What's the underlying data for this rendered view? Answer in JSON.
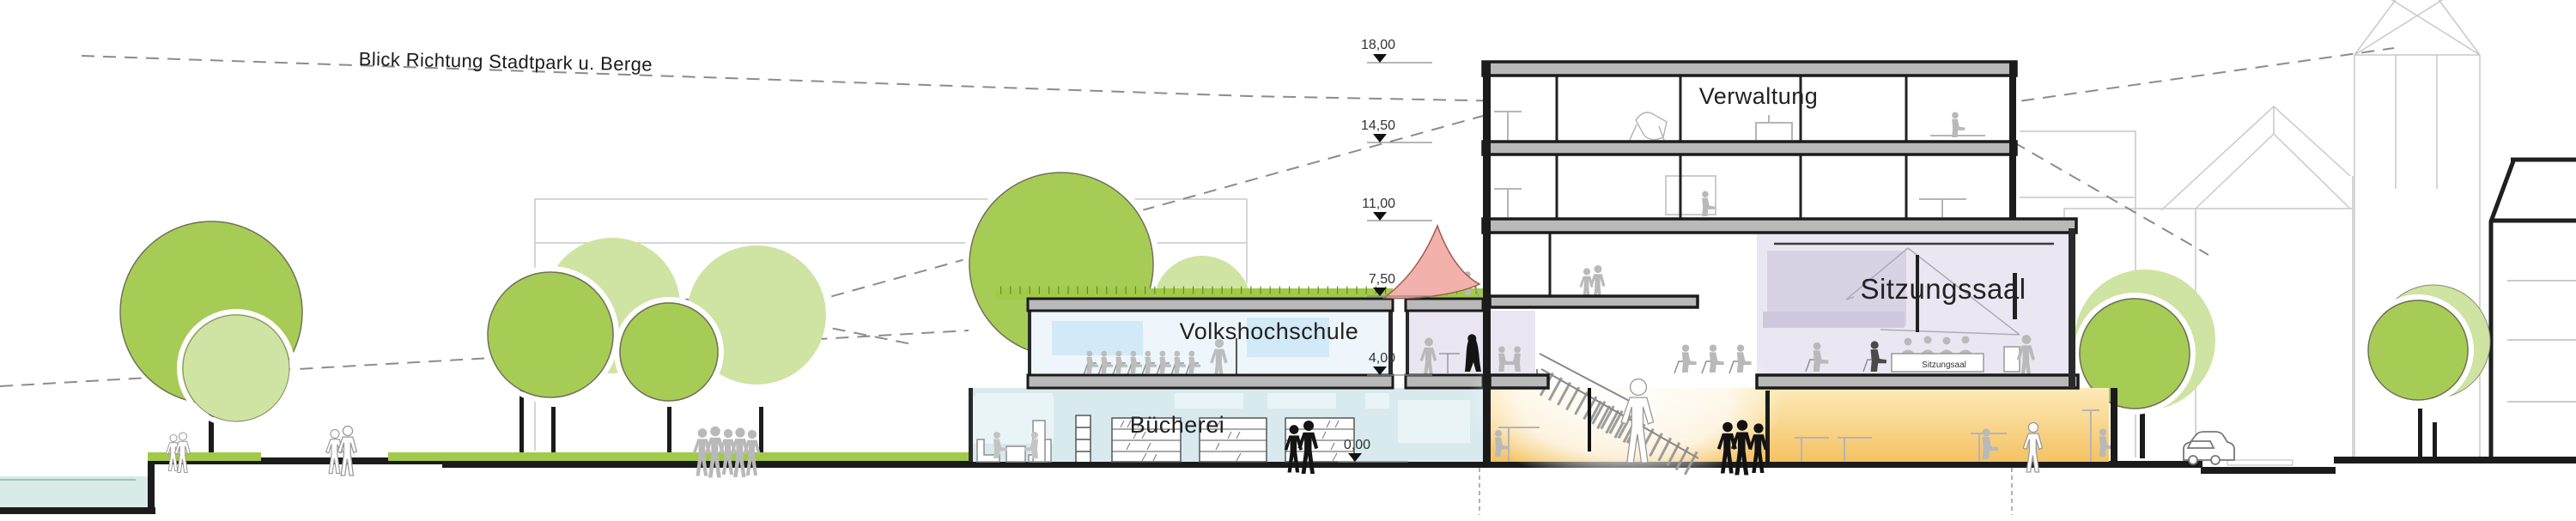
{
  "annotations": {
    "view_direction": "Blick Richtung Stadtpark u. Berge"
  },
  "rooms": {
    "verwaltung": "Verwaltung",
    "sitzungssaal": "Sitzungssaal",
    "sitzungssaal_small": "Sitzungsaal",
    "volkshochschule": "Volkshochschule",
    "buecherei": "Bücherei"
  },
  "elevations": [
    {
      "label": "18,00"
    },
    {
      "label": "14,50"
    },
    {
      "label": "11,00"
    },
    {
      "label": "7,50"
    },
    {
      "label": "4,00"
    },
    {
      "label": "0,00"
    }
  ],
  "colors": {
    "tree_green": "#a6cc56",
    "tree_light_green": "#cfe3a3",
    "grass_green": "#a2ca49",
    "slab_gray": "#b9b9b9",
    "wall_black": "#1b1b1b",
    "vhs_blue": "#eef6fc",
    "library_blue": "#d8eaee",
    "hall_lavender": "#eae7f2",
    "foyer_yellow": "#f4c263",
    "sail_pink": "#f3b1ac",
    "pond_cyan": "#d8ebe9"
  }
}
